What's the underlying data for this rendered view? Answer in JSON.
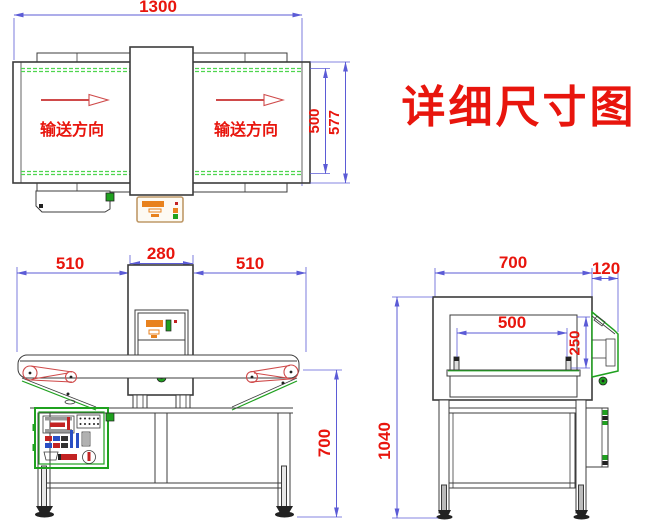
{
  "title": "详细尺寸图",
  "colors": {
    "dimension": "#5b5bd6",
    "label": "#e8150d",
    "outline": "#3c3c3c",
    "green": "#1fa11f",
    "belt_green": "#4fd54f",
    "roller_red": "#cf4a4a",
    "orange": "#e8821e",
    "panel_tan": "#bf9968",
    "blue_part": "#2a4fc4",
    "red_part": "#c22222"
  },
  "views": {
    "top": {
      "dim_width": "1300",
      "dim_belt_width": "500",
      "dim_overall_width": "577",
      "direction_label_left": "输送方向",
      "direction_label_right": "输送方向"
    },
    "front": {
      "dim_left": "510",
      "dim_head": "280",
      "dim_right": "510",
      "dim_height": "700"
    },
    "side": {
      "dim_depth": "700",
      "dim_panel": "120",
      "dim_aperture_width": "500",
      "dim_aperture_height": "250",
      "dim_height": "1040"
    }
  }
}
